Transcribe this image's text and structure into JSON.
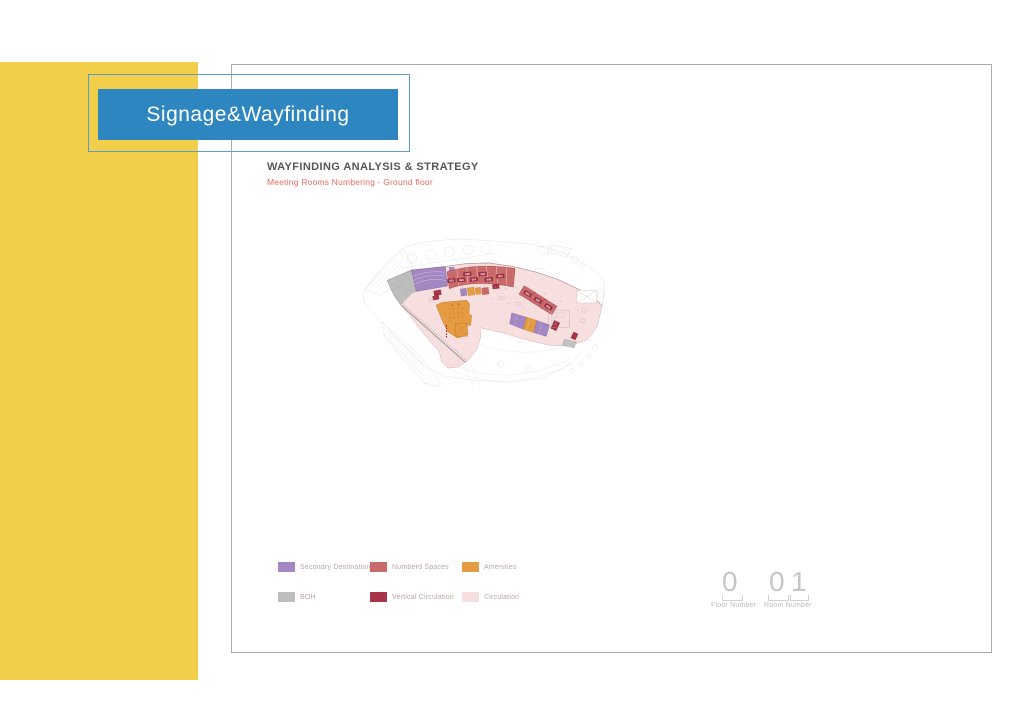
{
  "slide": {
    "badge_title": "Signage&Wayfinding",
    "heading": "WAYFINDING ANALYSIS & STRATEGY",
    "subheading": "Meeting Rooms Numbering - Ground floor"
  },
  "colors": {
    "accent_yellow": "#F2CF4A",
    "accent_blue": "#2E86C0",
    "secondary_destination": "#A287C2",
    "numbered_spaces": "#CA6B6B",
    "amenities": "#E59B42",
    "boh": "#BDBDBD",
    "vertical_circulation": "#A93448",
    "circulation": "#F7DFDF",
    "room_label_box": "#9C2E43"
  },
  "legend": {
    "items": [
      {
        "label": "Secondry Destination",
        "color": "#A287C2"
      },
      {
        "label": "Numberd Spaces",
        "color": "#CA6B6B"
      },
      {
        "label": "Amenities",
        "color": "#E59B42"
      },
      {
        "label": "BOH",
        "color": "#BDBDBD"
      },
      {
        "label": "Vertical Circulation",
        "color": "#A93448"
      },
      {
        "label": "Circulation",
        "color": "#F7DFDF"
      }
    ]
  },
  "numbering": {
    "floor_digit": "0",
    "floor_label": "Floor Number",
    "room_digit_1": "0",
    "room_digit_2": "1",
    "room_label": "Room Number"
  },
  "plan": {
    "rooms": [
      "010",
      "009",
      "008",
      "007",
      "006",
      "005",
      "004",
      "003",
      "002",
      "001"
    ]
  }
}
